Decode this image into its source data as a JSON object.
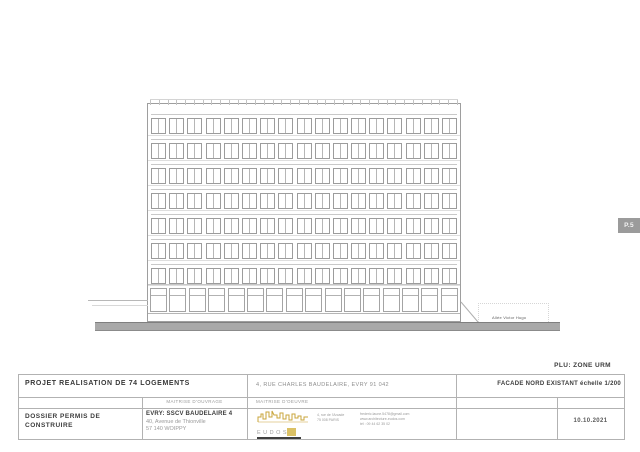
{
  "page_tab": {
    "label": "P.5"
  },
  "plu_note": "PLU: ZONE URM",
  "drawing": {
    "type": "elevation",
    "street_label": "Allée Victor Hugo",
    "floors": 7,
    "windows_per_floor": 17,
    "ground_bays": 16,
    "railing_ticks": 36
  },
  "colors": {
    "logo_gold": "#d2b13f",
    "ground_band": "#a9a9a9",
    "tab_bg": "#9b9b9b"
  },
  "title_block": {
    "project": "PROJET REALISATION DE 74 LOGEMENTS",
    "address": "4, RUE CHARLES BAUDELAIRE, EVRY  91 042",
    "sheet_title": "FACADE NORD EXISTANT  échelle 1/200",
    "col_ouvrage_header": "MAITRISE D'OUVRAGE",
    "col_oeuvre_header": "MAITRISE D'OEUVRE",
    "doc_type": "DOSSIER PERMIS DE CONSTRUIRE",
    "client_name": "EVRY: SSCV BAUDELAIRE 4",
    "client_addr1": "40, Avenue de Thionville",
    "client_addr2": "57 140 WOIPPY",
    "logo_text": "EUDOS",
    "architect_addr1": "4, rue de l'Arcade",
    "architect_addr2": "75 008 PARIS",
    "architect_email": "frederic.laune.5478@gmail.com",
    "architect_web": "www.architecture-eudos.com",
    "architect_tel": "tél : 09 44 62 35 02",
    "date": "10.10.2021"
  }
}
